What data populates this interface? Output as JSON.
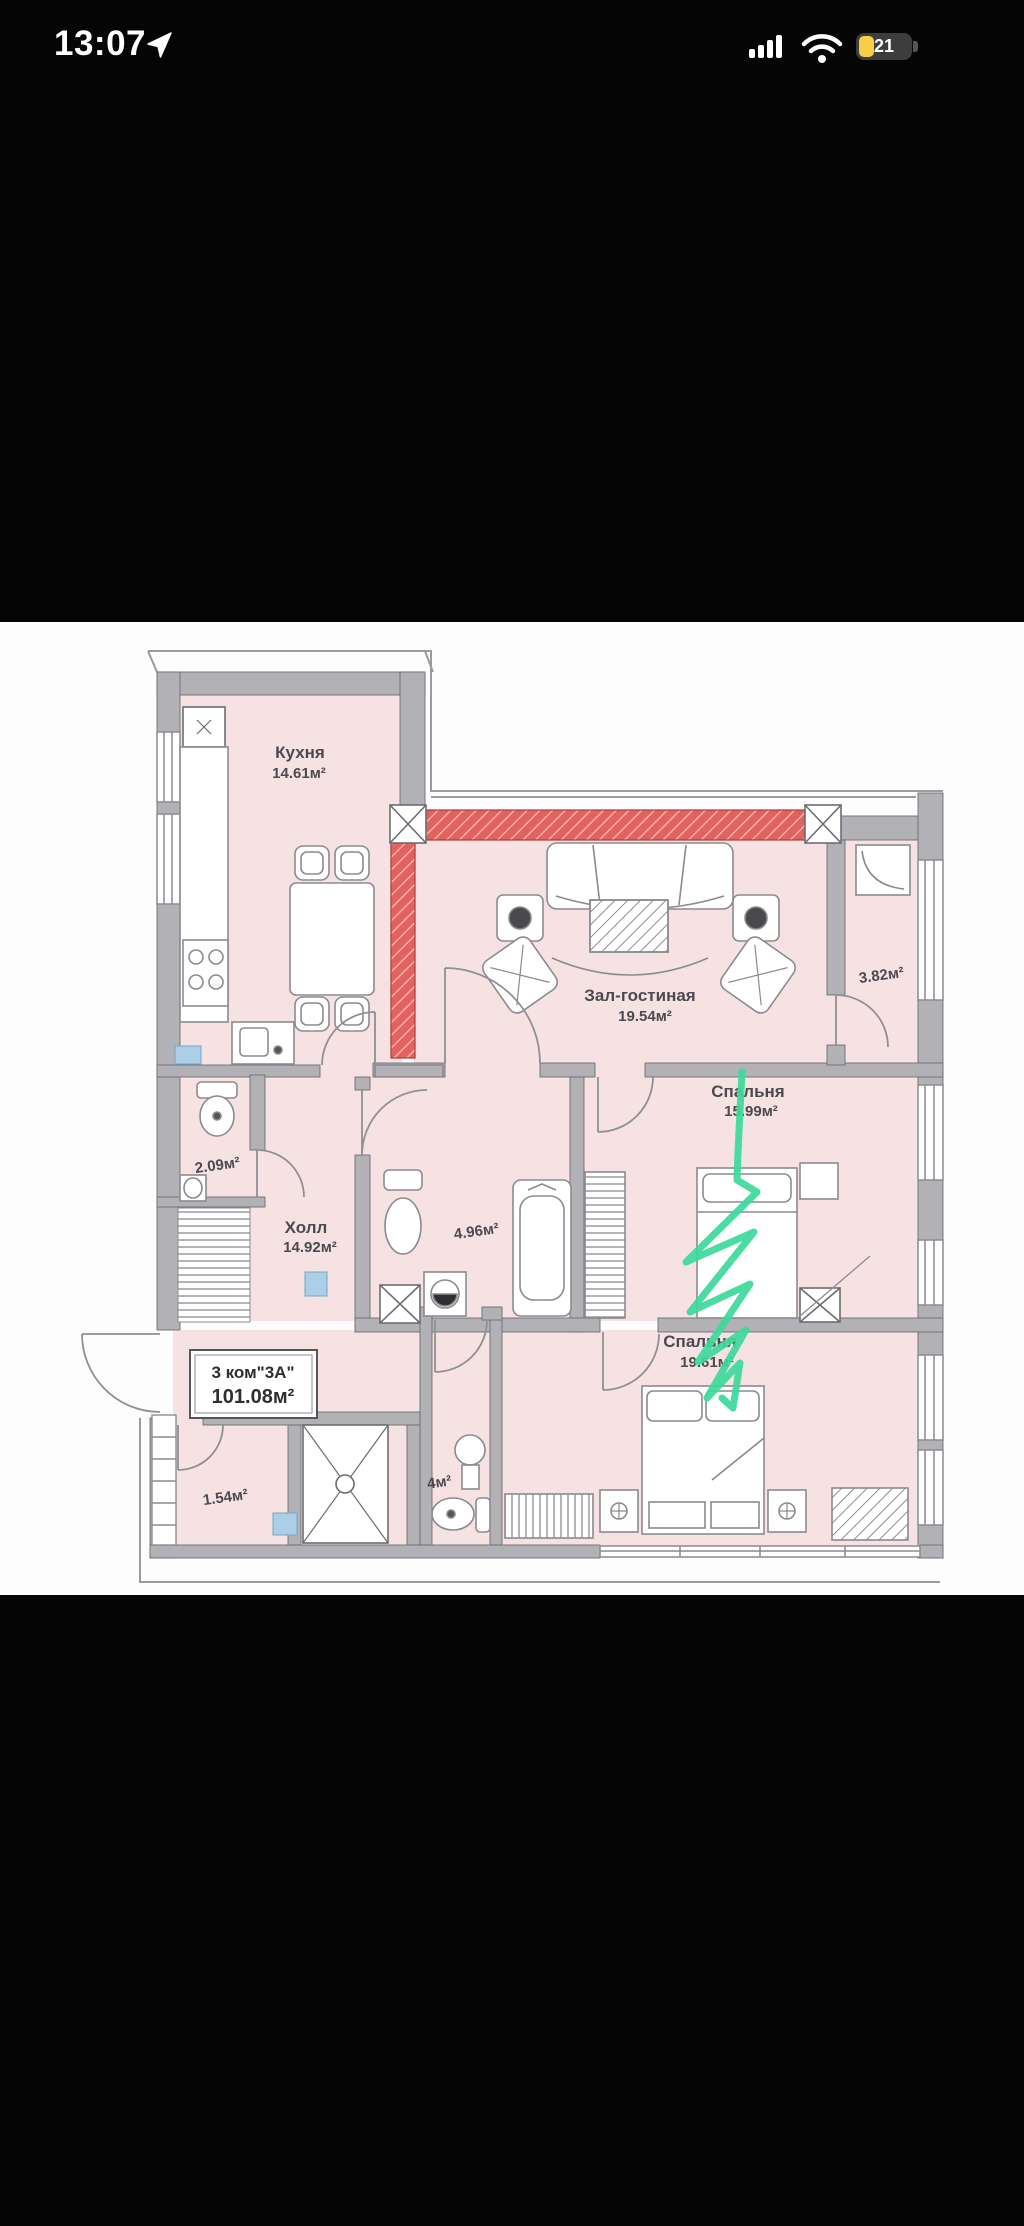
{
  "status_bar": {
    "time": "13:07",
    "battery_level": "21",
    "icons": {
      "location": "location-arrow-icon",
      "cellular": "cellular-signal-icon",
      "wifi": "wifi-icon",
      "battery": "battery-low-power-icon"
    }
  },
  "floor_plan": {
    "apartment": {
      "type_label": "3 ком\"3А\"",
      "total_area": "101.08м²"
    },
    "rooms": {
      "kitchen": {
        "name": "Кухня",
        "area": "14.61м²"
      },
      "living": {
        "name": "Зал-гостиная",
        "area": "19.54м²"
      },
      "bedroom1": {
        "name": "Спальня",
        "area": "15.99м²"
      },
      "bedroom2": {
        "name": "Спальня",
        "area": "19.61м²"
      },
      "hall": {
        "name": "Холл",
        "area": "14.92м²"
      },
      "wc": {
        "area": "2.09м²"
      },
      "bathroom": {
        "area": "4.96м²"
      },
      "bathroom2": {
        "area": "4м²"
      },
      "balcony": {
        "area": "3.82м²"
      },
      "storage": {
        "area": "1.54м²"
      }
    },
    "colors": {
      "room_fill": "#f7e2e3",
      "wall": "#b2b2b6",
      "highlight_wall": "#e2625f",
      "marker_annotation": "#3cd999"
    }
  }
}
